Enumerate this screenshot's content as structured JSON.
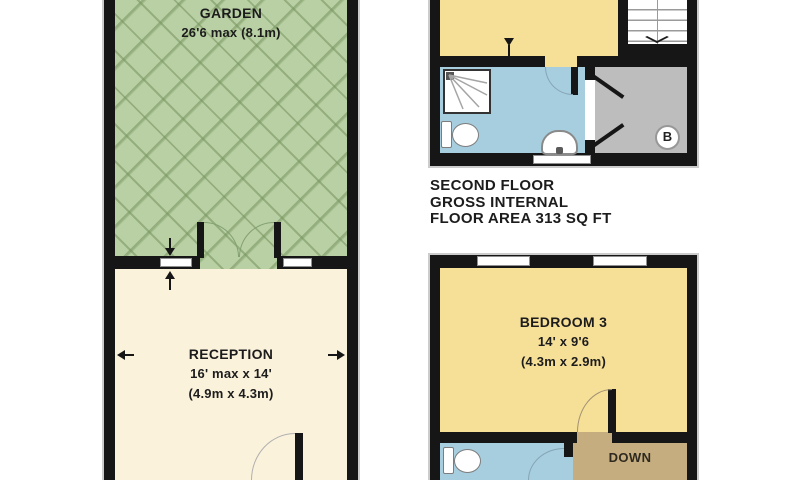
{
  "colors": {
    "garden_green": "#b9d0a5",
    "reception_cream": "#fbf2dc",
    "room_yellow": "#f6df97",
    "bath_blue": "#a6cedf",
    "cupboard_gray": "#bdbdbd",
    "landing_tan": "#c6ad80",
    "wall": "#161616",
    "text": "#1c1c1c"
  },
  "ground_floor_plan": {
    "garden": {
      "label": "GARDEN",
      "dimensions": "26'6 max (8.1m)"
    },
    "reception": {
      "label": "RECEPTION",
      "dimensions_imperial": "16' max x 14'",
      "dimensions_metric": "(4.9m x 4.3m)"
    }
  },
  "floor_note": {
    "lines": [
      "SECOND FLOOR",
      "GROSS INTERNAL",
      "FLOOR AREA 313 SQ FT"
    ]
  },
  "second_floor_plan": {
    "boiler_label": "B",
    "fixtures": [
      "shower",
      "toilet",
      "sink",
      "stairs-down",
      "boiler-cupboard"
    ]
  },
  "bedroom_plan": {
    "bedroom": {
      "label": "BEDROOM 3",
      "dimensions_imperial": "14' x 9'6",
      "dimensions_metric": "(4.3m x 2.9m)"
    },
    "landing": {
      "down_label": "DOWN"
    },
    "fixtures": [
      "toilet"
    ]
  }
}
